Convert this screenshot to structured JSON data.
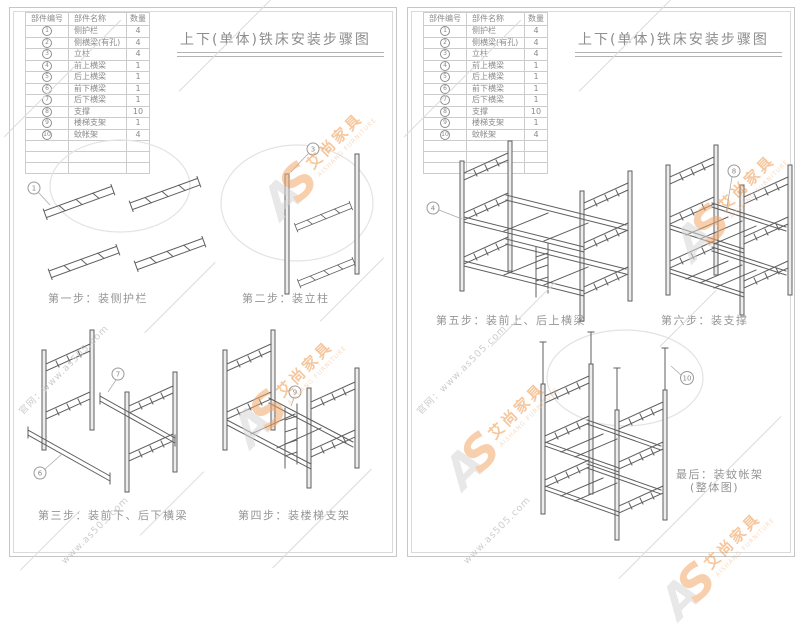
{
  "document": {
    "title": "上下(单体)铁床安装步骤图"
  },
  "parts_table": {
    "headers": {
      "no": "部件编号",
      "name": "部件名称",
      "qty": "数量"
    },
    "rows": [
      {
        "no": "1",
        "name": "侧护栏",
        "qty": "4"
      },
      {
        "no": "2",
        "name": "侧横梁(有孔)",
        "qty": "4"
      },
      {
        "no": "3",
        "name": "立柱",
        "qty": "4"
      },
      {
        "no": "4",
        "name": "前上横梁",
        "qty": "1"
      },
      {
        "no": "5",
        "name": "后上横梁",
        "qty": "1"
      },
      {
        "no": "6",
        "name": "前下横梁",
        "qty": "1"
      },
      {
        "no": "7",
        "name": "后下横梁",
        "qty": "1"
      },
      {
        "no": "8",
        "name": "支撑",
        "qty": "10"
      },
      {
        "no": "9",
        "name": "楼梯支架",
        "qty": "1"
      },
      {
        "no": "10",
        "name": "蚊帐架",
        "qty": "4"
      }
    ]
  },
  "steps": {
    "step1": "第一步：装侧护栏",
    "step2": "第二步：装立柱",
    "step3": "第三步：装前下、后下横梁",
    "step4": "第四步：装楼梯支架",
    "step5": "第五步：装前上、后上横梁",
    "step6": "第六步：装支撑",
    "final_line1": "最后：装蚊帐架",
    "final_line2": "(整体图)"
  },
  "callouts": {
    "step1": "1",
    "step2": "3",
    "step3_rear": "7",
    "step3_front": "6",
    "step4": "9",
    "step5": "4",
    "step6": "8",
    "final": "10"
  },
  "watermark": {
    "monogram_a": "A",
    "monogram_s": "S",
    "brand_cn": "艾尚家具",
    "brand_en": "AISHANG FURNITURE",
    "site": "www.as505.com",
    "site_labeled": "官网：www.as505.com"
  },
  "colors": {
    "brand_orange": "#ef9a4f",
    "drawing_gray": "#5f5f5f",
    "watermark_gray": "#c8c8c8"
  }
}
